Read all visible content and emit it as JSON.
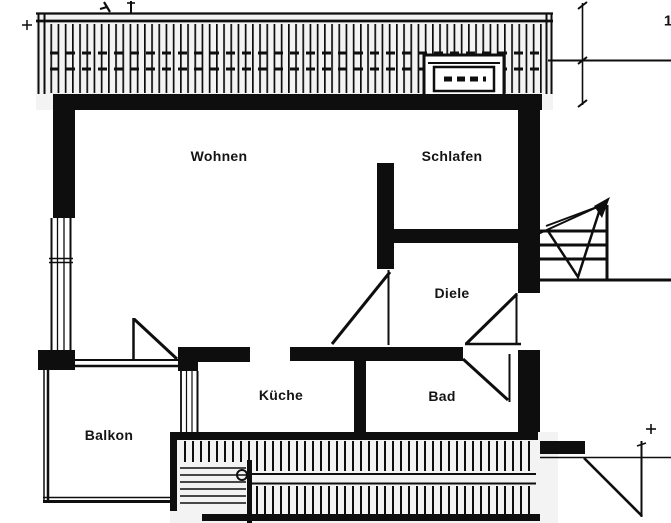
{
  "document": {
    "kind": "apartment floor plan (scanned drawing)",
    "page_number": "1"
  },
  "colors": {
    "ink": "#0e0e0e",
    "paper": "#ffffff",
    "band_fill": "#f3f3f3"
  },
  "rooms": [
    {
      "name": "wohnen",
      "label": "Wohnen"
    },
    {
      "name": "schlafen",
      "label": "Schlafen"
    },
    {
      "name": "diele",
      "label": "Diele"
    },
    {
      "name": "kueche",
      "label": "Küche"
    },
    {
      "name": "bad",
      "label": "Bad"
    },
    {
      "name": "balkon",
      "label": "Balkon"
    }
  ],
  "symbols": [
    {
      "name": "roof-terrace-hatch-top"
    },
    {
      "name": "roof-window"
    },
    {
      "name": "window-left"
    },
    {
      "name": "balcony-door-swing"
    },
    {
      "name": "room-door-swing-diele"
    },
    {
      "name": "entry-door-swing"
    },
    {
      "name": "bath-door-swing"
    },
    {
      "name": "staircase-with-direction-arrow"
    },
    {
      "name": "terrace-stairs-hatch-bottom"
    },
    {
      "name": "neighbor-door-swing"
    },
    {
      "name": "dimension-lines"
    }
  ]
}
